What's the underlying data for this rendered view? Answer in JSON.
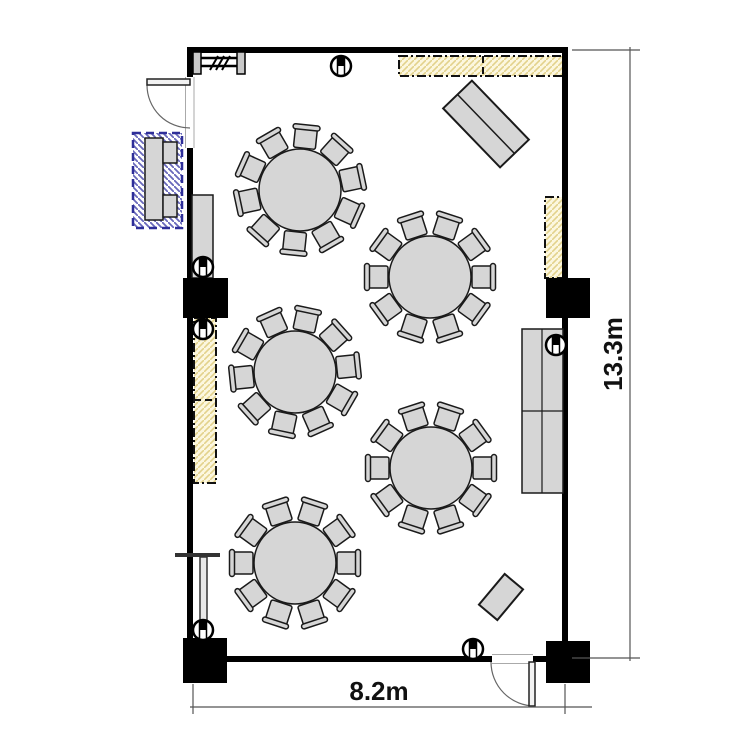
{
  "title": "Banquet room floor plan",
  "dimensions": {
    "width_label": "8.2m",
    "height_label": "13.3m"
  },
  "colors": {
    "wall": "#000000",
    "line": "#1a1a1a",
    "furniture_fill": "#d6d6d6",
    "zone_fill": "#fcf7df",
    "zone_hatch": "#e3d28c",
    "zone_border": "#111111",
    "blue_hatch": "#6868bb",
    "blue_border": "#2e2e99",
    "dim_line": "#555555",
    "text": "#111111"
  },
  "room": {
    "x": 190,
    "y": 50,
    "w": 375,
    "h": 609,
    "wall_thickness": 6
  },
  "tables": {
    "count": 5,
    "seats_per_table": 10,
    "radius": 41,
    "positions": [
      {
        "cx": 300,
        "cy": 190,
        "rot": 12
      },
      {
        "cx": 430,
        "cy": 277,
        "rot": 0
      },
      {
        "cx": 295,
        "cy": 372,
        "rot": 6
      },
      {
        "cx": 431,
        "cy": 468,
        "rot": 0
      },
      {
        "cx": 295,
        "cy": 563,
        "rot": 0
      }
    ]
  },
  "square_columns": [
    {
      "x": 183,
      "y": 278,
      "w": 45,
      "h": 40
    },
    {
      "x": 546,
      "y": 278,
      "w": 44,
      "h": 40
    },
    {
      "x": 183,
      "y": 638,
      "w": 44,
      "h": 45
    },
    {
      "x": 546,
      "y": 641,
      "w": 44,
      "h": 42
    }
  ],
  "round_markers": [
    {
      "cx": 341,
      "cy": 66
    },
    {
      "cx": 203,
      "cy": 267
    },
    {
      "cx": 203,
      "cy": 329
    },
    {
      "cx": 203,
      "cy": 630
    },
    {
      "cx": 556,
      "cy": 345
    },
    {
      "cx": 473,
      "cy": 649
    }
  ],
  "service_zones": [
    {
      "x": 399,
      "y": 56,
      "w": 165,
      "h": 20,
      "divider": {
        "dir": "v",
        "pos": 483
      }
    },
    {
      "x": 545,
      "y": 197,
      "w": 21,
      "h": 81
    },
    {
      "x": 194,
      "y": 318,
      "w": 22,
      "h": 165,
      "divider": {
        "dir": "h",
        "pos": 400
      }
    }
  ],
  "blue_service_counter": {
    "outer": {
      "x": 133,
      "y": 133,
      "w": 49,
      "h": 95
    },
    "counter": {
      "x": 145,
      "y": 138,
      "w": 18,
      "h": 82
    },
    "items": [
      {
        "x": 163,
        "y": 142,
        "w": 14,
        "h": 21
      },
      {
        "x": 163,
        "y": 195,
        "w": 14,
        "h": 22
      }
    ]
  },
  "furniture": [
    {
      "type": "rect",
      "x": 192,
      "y": 195,
      "w": 21,
      "h": 83,
      "name": "side-cabinet"
    },
    {
      "type": "rect",
      "x": 522,
      "y": 329,
      "w": 41,
      "h": 164,
      "hdiv": 411,
      "vdiv": 542,
      "name": "service-counter"
    },
    {
      "type": "rot-rect",
      "cx": 486,
      "cy": 124,
      "w": 82,
      "h": 40,
      "angle": 46,
      "divider": true,
      "name": "buffet-table"
    },
    {
      "type": "rot-rect",
      "cx": 501,
      "cy": 597,
      "w": 40,
      "h": 24,
      "angle": -50,
      "divider": false,
      "name": "small-table"
    }
  ],
  "doors": [
    {
      "side": "left",
      "gap": {
        "x": 185.5,
        "y": 77,
        "w": 8.5,
        "h": 71
      },
      "leaf": {
        "x": 147,
        "y": 79,
        "w": 43,
        "h": 6
      },
      "arc": "M147,85 A43,43 0 0 0 190,128"
    },
    {
      "side": "bottom",
      "gap": {
        "x": 492,
        "y": 654.5,
        "w": 41,
        "h": 9
      },
      "leaf": {
        "x": 529,
        "y": 662,
        "w": 6,
        "h": 44
      },
      "arc": "M491,662 A44,44 0 0 0 535,706"
    }
  ],
  "window_partition": {
    "x1": 196,
    "x2": 244,
    "lines_y": [
      58,
      66
    ],
    "posts": [
      193,
      237
    ],
    "post_y": 52,
    "post_w": 8,
    "post_h": 22,
    "slashes_x": [
      210,
      216,
      222
    ],
    "slash_y1": 70,
    "slash_y2": 56,
    "slash_dx": 8
  },
  "stand": {
    "bar": {
      "x1": 175,
      "y1": 555,
      "x2": 220,
      "y2": 555
    },
    "pole": {
      "x": 200,
      "y": 557,
      "w": 7,
      "h": 66
    }
  },
  "dimension_layout": {
    "bottom": {
      "line_y": 707,
      "x1": 190,
      "x2": 592,
      "ext": [
        {
          "x": 193,
          "y1": 684,
          "y2": 714
        },
        {
          "x": 565,
          "y1": 684,
          "y2": 714
        }
      ],
      "label_x": 379,
      "label_y": 700
    },
    "right": {
      "line_x": 630,
      "y1": 47,
      "y2": 661,
      "ext": [
        {
          "y": 50,
          "x1": 572,
          "x2": 640
        },
        {
          "y": 658,
          "x1": 572,
          "x2": 640
        }
      ],
      "label_x": 622,
      "label_y": 354
    }
  }
}
